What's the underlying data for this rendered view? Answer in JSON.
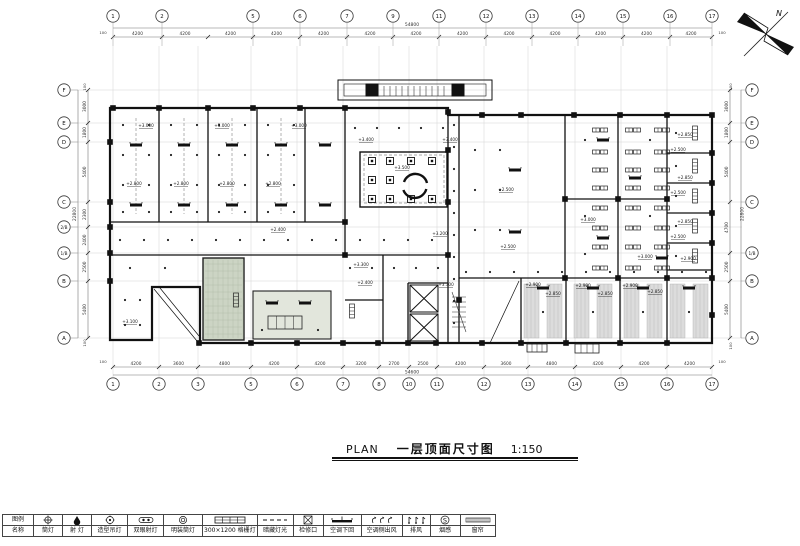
{
  "title": {
    "plan": "PLAN",
    "name": "一层顶面尺寸图",
    "scale": "1:150"
  },
  "north": {
    "label": "N"
  },
  "grid": {
    "top": {
      "bubbles": [
        {
          "label": "1",
          "x": 113
        },
        {
          "label": "2",
          "x": 162
        },
        {
          "label": "5",
          "x": 253
        },
        {
          "label": "6",
          "x": 300
        },
        {
          "label": "7",
          "x": 347
        },
        {
          "label": "9",
          "x": 393
        },
        {
          "label": "11",
          "x": 439
        },
        {
          "label": "12",
          "x": 486
        },
        {
          "label": "13",
          "x": 532
        },
        {
          "label": "14",
          "x": 578
        },
        {
          "label": "15",
          "x": 623
        },
        {
          "label": "16",
          "x": 670
        },
        {
          "label": "17",
          "x": 712
        }
      ],
      "ticks": [
        113,
        162,
        208,
        253,
        300,
        347,
        393,
        439,
        486,
        532,
        578,
        623,
        670,
        712
      ],
      "dims": [
        "4200",
        "4200",
        "4200",
        "4200",
        "4200",
        "4200",
        "4200",
        "4200",
        "4200",
        "4200",
        "4200",
        "4200",
        "4200"
      ],
      "total": "54800"
    },
    "bottom": {
      "bubbles": [
        {
          "label": "1",
          "x": 113
        },
        {
          "label": "2",
          "x": 159
        },
        {
          "label": "3",
          "x": 198
        },
        {
          "label": "5",
          "x": 251
        },
        {
          "label": "6",
          "x": 297
        },
        {
          "label": "7",
          "x": 343
        },
        {
          "label": "8",
          "x": 379
        },
        {
          "label": "10",
          "x": 409
        },
        {
          "label": "11",
          "x": 437
        },
        {
          "label": "12",
          "x": 484
        },
        {
          "label": "13",
          "x": 528
        },
        {
          "label": "14",
          "x": 575
        },
        {
          "label": "15",
          "x": 621
        },
        {
          "label": "16",
          "x": 667
        },
        {
          "label": "17",
          "x": 712
        }
      ],
      "ticks": [
        113,
        159,
        198,
        251,
        297,
        343,
        379,
        409,
        437,
        484,
        528,
        575,
        621,
        667,
        712
      ],
      "dims": [
        "4200",
        "3600",
        "4800",
        "4200",
        "4200",
        "3200",
        "2700",
        "2500",
        "4200",
        "3600",
        "4800",
        "4200",
        "4200",
        "4200"
      ],
      "total": "54600"
    },
    "left": {
      "bubbles": [
        {
          "label": "F",
          "y": 90
        },
        {
          "label": "E",
          "y": 123
        },
        {
          "label": "D",
          "y": 142
        },
        {
          "label": "C",
          "y": 202
        },
        {
          "label": "2/B",
          "y": 227
        },
        {
          "label": "1/B",
          "y": 253
        },
        {
          "label": "B",
          "y": 281
        },
        {
          "label": "A",
          "y": 338
        }
      ],
      "ticks": [
        90,
        123,
        142,
        202,
        227,
        253,
        281,
        338
      ],
      "dims": [
        "3000",
        "1800",
        "5400",
        "2300",
        "2400",
        "2500",
        "5400"
      ],
      "total": "22800"
    },
    "right": {
      "bubbles": [
        {
          "label": "F",
          "y": 90
        },
        {
          "label": "E",
          "y": 123
        },
        {
          "label": "D",
          "y": 142
        },
        {
          "label": "C",
          "y": 202
        },
        {
          "label": "1/B",
          "y": 253
        },
        {
          "label": "B",
          "y": 281
        },
        {
          "label": "A",
          "y": 338
        }
      ],
      "ticks": [
        90,
        123,
        142,
        202,
        253,
        281,
        338
      ],
      "dims": [
        "3000",
        "1800",
        "5400",
        "4700",
        "2500",
        "5400"
      ],
      "total": "22800"
    }
  },
  "edge_labels": [
    {
      "t": "100",
      "x": 103,
      "y": 34,
      "r": 0
    },
    {
      "t": "100",
      "x": 722,
      "y": 34,
      "r": 0
    },
    {
      "t": "100",
      "x": 103,
      "y": 363,
      "r": 0
    },
    {
      "t": "100",
      "x": 722,
      "y": 363,
      "r": 0
    },
    {
      "t": "100",
      "x": 86,
      "y": 87,
      "r": -90
    },
    {
      "t": "100",
      "x": 86,
      "y": 343,
      "r": -90
    },
    {
      "t": "100",
      "x": 732,
      "y": 87,
      "r": -90
    },
    {
      "t": "100",
      "x": 732,
      "y": 346,
      "r": -90
    }
  ],
  "elevations": [
    {
      "t": "+3.000",
      "x": 146,
      "y": 127
    },
    {
      "t": "+3.000",
      "x": 222,
      "y": 127
    },
    {
      "t": "+3.000",
      "x": 299,
      "y": 127
    },
    {
      "t": "+2.800",
      "x": 134,
      "y": 185
    },
    {
      "t": "+2.800",
      "x": 181,
      "y": 185
    },
    {
      "t": "+2.800",
      "x": 227,
      "y": 185
    },
    {
      "t": "+2.800",
      "x": 273,
      "y": 185
    },
    {
      "t": "+2.400",
      "x": 278,
      "y": 231
    },
    {
      "t": "+3.100",
      "x": 130,
      "y": 323
    },
    {
      "t": "+3.400",
      "x": 366,
      "y": 141
    },
    {
      "t": "+3.400",
      "x": 450,
      "y": 141
    },
    {
      "t": "+3.500",
      "x": 402,
      "y": 169
    },
    {
      "t": "+2.500",
      "x": 506,
      "y": 191
    },
    {
      "t": "+2.500",
      "x": 508,
      "y": 248
    },
    {
      "t": "+3.000",
      "x": 588,
      "y": 221
    },
    {
      "t": "+3.000",
      "x": 645,
      "y": 258
    },
    {
      "t": "+2.850",
      "x": 685,
      "y": 136
    },
    {
      "t": "+2.500",
      "x": 678,
      "y": 151
    },
    {
      "t": "+2.850",
      "x": 685,
      "y": 179
    },
    {
      "t": "+2.500",
      "x": 678,
      "y": 194
    },
    {
      "t": "+2.850",
      "x": 685,
      "y": 223
    },
    {
      "t": "+2.500",
      "x": 678,
      "y": 238
    },
    {
      "t": "+2.900",
      "x": 688,
      "y": 260
    },
    {
      "t": "+3.200",
      "x": 440,
      "y": 235
    },
    {
      "t": "+3.300",
      "x": 361,
      "y": 266
    },
    {
      "t": "+2.400",
      "x": 365,
      "y": 284
    },
    {
      "t": "+3.300",
      "x": 446,
      "y": 286
    },
    {
      "t": "+2.900",
      "x": 533,
      "y": 286
    },
    {
      "t": "+2.850",
      "x": 553,
      "y": 295
    },
    {
      "t": "+2.900",
      "x": 583,
      "y": 287
    },
    {
      "t": "+2.850",
      "x": 605,
      "y": 295
    },
    {
      "t": "+2.900",
      "x": 630,
      "y": 287
    },
    {
      "t": "+2.850",
      "x": 655,
      "y": 293
    }
  ],
  "legend": {
    "row1_header": "图例",
    "row2_header": "名称",
    "smoke_glyph": "S",
    "items": [
      {
        "name": "筒灯"
      },
      {
        "name": "射 灯"
      },
      {
        "name": "造型吊灯"
      },
      {
        "name": "双眼射灯"
      },
      {
        "name": "明装筒灯"
      },
      {
        "name": "300×1200 格栅灯"
      },
      {
        "name": "暗藏灯光"
      },
      {
        "name": "检修口"
      },
      {
        "name": "空调下回"
      },
      {
        "name": "空调侧出风"
      },
      {
        "name": "排风"
      },
      {
        "name": "烟感"
      },
      {
        "name": "窗帘"
      }
    ]
  }
}
